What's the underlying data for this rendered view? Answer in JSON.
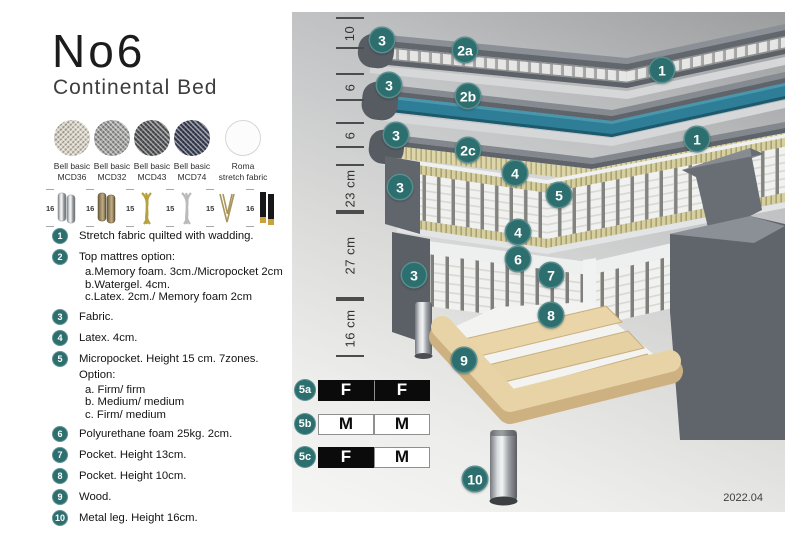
{
  "header": {
    "title": "No6",
    "subtitle": "Continental Bed"
  },
  "swatches": [
    {
      "line1": "Bell basic",
      "line2": "MCD36"
    },
    {
      "line1": "Bell basic",
      "line2": "MCD32"
    },
    {
      "line1": "Bell basic",
      "line2": "MCD43"
    },
    {
      "line1": "Bell basic",
      "line2": "MCD74"
    },
    {
      "line1": "Roma",
      "line2": "stretch fabric"
    }
  ],
  "legs": [
    {
      "height": "16",
      "type": "cylinder-silver"
    },
    {
      "height": "16",
      "type": "cylinder-bronze"
    },
    {
      "height": "15",
      "type": "twisted-gold"
    },
    {
      "height": "15",
      "type": "twisted-silver"
    },
    {
      "height": "15",
      "type": "hairpin-metal"
    },
    {
      "height": "16",
      "type": "black-gold-tip"
    }
  ],
  "spec_list": [
    {
      "num": "1",
      "text": "Stretch fabric quilted with wadding."
    },
    {
      "num": "2",
      "text": "Top mattres option:",
      "subs": [
        "a.Memory foam. 3cm./Micropocket 2cm",
        "b.Watergel. 4cm.",
        "c.Latex. 2cm./ Memory foam 2cm"
      ]
    },
    {
      "num": "3",
      "text": "Fabric."
    },
    {
      "num": "4",
      "text": "Latex. 4cm."
    },
    {
      "num": "5",
      "text": "Micropocket. Height 15 cm. 7zones. Option:",
      "subs": [
        "a. Firm/ firm",
        "b. Medium/ medium",
        "c. Firm/ medium"
      ]
    },
    {
      "num": "6",
      "text": "Polyurethane foam 25kg. 2cm."
    },
    {
      "num": "7",
      "text": "Pocket. Height 13cm."
    },
    {
      "num": "8",
      "text": "Pocket. Height 10cm."
    },
    {
      "num": "9",
      "text": "Wood."
    },
    {
      "num": "10",
      "text": "Metal leg. Height 16cm."
    }
  ],
  "diagram": {
    "dimensions": [
      "10",
      "6",
      "6",
      "23 cm",
      "27 cm",
      "16 cm"
    ],
    "badges": [
      "3",
      "2a",
      "1",
      "3",
      "2b",
      "1",
      "3",
      "2c",
      "4",
      "5",
      "3",
      "4",
      "6",
      "7",
      "3",
      "8",
      "9",
      "10"
    ],
    "firmness": [
      {
        "label": "5a",
        "cells": [
          "F",
          "F"
        ]
      },
      {
        "label": "5b",
        "cells": [
          "M",
          "M"
        ]
      },
      {
        "label": "5c",
        "cells": [
          "F",
          "M"
        ]
      }
    ],
    "version": "2022.04"
  },
  "colors": {
    "badge_teal": "#2d6f6f",
    "watergel_teal": "#2f7e97",
    "firm_black": "#0b0b0b",
    "wood": "#e6d0a2"
  }
}
